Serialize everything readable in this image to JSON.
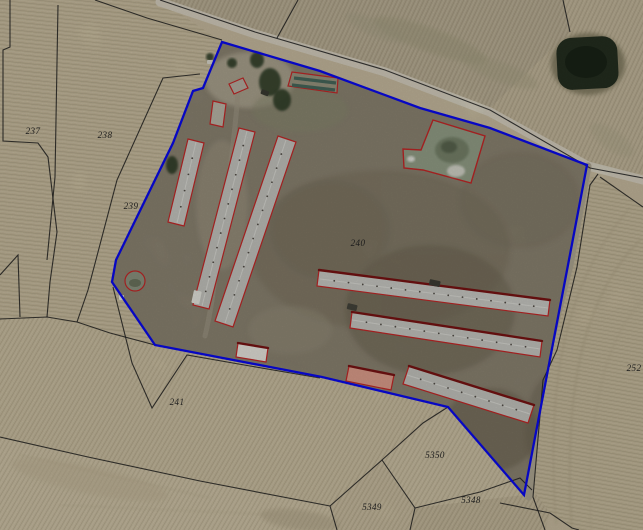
{
  "map": {
    "width": 643,
    "height": 530,
    "palette": {
      "base": "#c8bca0",
      "farm_ground": "#8d8573",
      "road": "#d7d1c0",
      "track": "#b0a894",
      "boundary_blue": "#0a0af0",
      "building_red": "#c62828",
      "building_dark_red": "#7a1414",
      "cadastral_line": "#1f1f1f",
      "label": "#1b1b1b",
      "pond_dark": "#252f21",
      "tree_green": "#2f3c28",
      "roof_gray": "#c9c9c3",
      "roof_pink": "#e0a18e",
      "roof_white": "#ebe9e1",
      "green_shed_stripe": "#47695c",
      "lagoon_green": "#95a189"
    },
    "parcel_labels": [
      {
        "text": "237",
        "x": 33,
        "y": 134
      },
      {
        "text": "238",
        "x": 105,
        "y": 138
      },
      {
        "text": "239",
        "x": 131,
        "y": 209
      },
      {
        "text": "240",
        "x": 358,
        "y": 246
      },
      {
        "text": "241",
        "x": 177,
        "y": 405
      },
      {
        "text": "5350",
        "x": 435,
        "y": 458
      },
      {
        "text": "5349",
        "x": 372,
        "y": 510
      },
      {
        "text": "5348",
        "x": 471,
        "y": 503
      },
      {
        "text": "252",
        "x": 634,
        "y": 371
      }
    ],
    "blue_boundary": {
      "points": "222,42 320,71 420,108 490,128 587,165 568,265 524,495 448,407 322,377 155,345 112,282 116,260 173,143 193,91 203,88",
      "width": 2.3
    },
    "cadastral_lines": [
      "10,0 10,47 3,50 3,141 38,143 48,157 57,232 50,282 47,317",
      "58,5 55,177 47,260",
      "0,275 18,255 20,317",
      "0,319 47,317 77,322 110,333 155,345",
      "200,74 163,78 117,180 88,290 77,322",
      "95,0 147,18 222,40",
      "160,0 255,32 385,70 490,110 590,168 643,178",
      "298,0 277,38",
      "563,0 570,32",
      "598,174 590,185 577,267 557,350 543,380 533,497 545,530",
      "600,177 643,207",
      "113,287 132,363 152,408 187,355 250,366 320,378",
      "0,437 88,457 200,481 330,506",
      "330,506 382,460 423,423 448,407",
      "330,506 337,530",
      "382,460 415,508 410,530",
      "415,508 480,492 520,478 532,490",
      "500,503 550,513 572,528 579,530"
    ],
    "fields": [
      {
        "name": "field-237-238",
        "points": "0,0 160,0 222,42 203,88 193,91 173,143 116,260 112,282 155,345 110,333 47,317 0,319",
        "fill": "#c6ba9c",
        "stripe": "p96"
      },
      {
        "name": "field-top-center",
        "points": "160,0 563,0 570,32 490,108 385,70 255,32",
        "fill": "#b7ac92",
        "stripe": "p25"
      },
      {
        "name": "field-pond-parcel",
        "points": "563,0 643,0 643,174 590,168 490,108 570,32",
        "fill": "#c0b498",
        "stripe": "p25"
      },
      {
        "name": "field-252",
        "points": "598,174 643,207 643,530 579,530 550,513 533,497 543,380 573,265 590,178",
        "fill": "#c4b89a",
        "stripe": "p100"
      },
      {
        "name": "field-bottom-right",
        "points": "415,508 533,490 550,513 545,530 410,530",
        "fill": "#c0b497",
        "stripe": "p30"
      },
      {
        "name": "field-5350",
        "points": "382,460 448,407 524,495 415,508",
        "fill": "#cbbfa2",
        "stripe": "p30"
      },
      {
        "name": "field-5349",
        "points": "330,506 382,460 415,508 410,530 337,530",
        "fill": "#c6ba9d",
        "stripe": "p30"
      },
      {
        "name": "field-241",
        "points": "0,319 47,317 110,333 155,345 322,377 448,407 423,423 382,460 330,506 200,481 88,457 0,437",
        "fill": "#c9bd9f",
        "stripe": "p30"
      },
      {
        "name": "field-bottom-left",
        "points": "0,437 88,457 200,481 330,506 337,530 0,530",
        "fill": "#cdc1a4",
        "stripe": "p30"
      }
    ],
    "field_accent_ellipses": [
      [
        430,
        40,
        60,
        12,
        "#a29c7e",
        0.45,
        20
      ],
      [
        500,
        72,
        40,
        10,
        "#a8a284",
        0.4,
        20
      ],
      [
        375,
        28,
        32,
        8,
        "#a8a287",
        0.4,
        24
      ],
      [
        612,
        140,
        26,
        10,
        "#b0a98c",
        0.4,
        35
      ],
      [
        90,
        480,
        80,
        14,
        "#c2b698",
        0.5,
        12
      ],
      [
        300,
        520,
        40,
        10,
        "#a89c80",
        0.4,
        8
      ]
    ],
    "field_accent_paths": [
      [
        "M640,240 C580,300 563,400 572,530",
        "#b6aa8c",
        2.5,
        0.55
      ],
      [
        "M643,300 C601,341 586,430 591,530",
        "#bbaf91",
        2.0,
        0.45
      ],
      [
        "M629,209 C558,290 547,400 556,523",
        "#b2a688",
        2.0,
        0.4
      ],
      [
        "M20,455 L210,498",
        "#b9ad90",
        1.5,
        0.35
      ],
      [
        "M60,505 L280,515",
        "#b9ad90",
        1.5,
        0.3
      ]
    ],
    "roads": [
      {
        "name": "main-road",
        "d": "M160,2 L255,34 L385,72 L490,112 L588,166 L643,180",
        "w": 9,
        "color": "#d7d1c0",
        "op": 1
      },
      {
        "name": "farm-track-east",
        "d": "M588,166 L570,265 L541,380 L529,497",
        "w": 7,
        "color": "#b0a894",
        "op": 1
      },
      {
        "name": "entrance-drive",
        "d": "M232,46 L242,78 L246,104",
        "w": 5,
        "color": "#c6bfab",
        "op": 0.9
      },
      {
        "name": "farm-inner-track",
        "d": "M239,80 C235,140 226,200 212,300 C209,318 207,328 205,336",
        "w": 5,
        "color": "#a59d88",
        "op": 0.65
      }
    ],
    "farm": {
      "fill": "#8d8573",
      "blotches": [
        [
          380,
          250,
          130,
          80,
          "#7b735e",
          0.45
        ],
        [
          430,
          310,
          85,
          65,
          "#6f6754",
          0.5
        ],
        [
          330,
          230,
          60,
          50,
          "#7a7260",
          0.45
        ],
        [
          490,
          430,
          48,
          42,
          "#6a6250",
          0.5
        ],
        [
          250,
          80,
          45,
          28,
          "#b4ac97",
          0.8
        ],
        [
          222,
          205,
          26,
          65,
          "#a29a86",
          0.55
        ],
        [
          290,
          330,
          42,
          24,
          "#98907c",
          0.55
        ],
        [
          300,
          110,
          48,
          22,
          "#8c8c72",
          0.5
        ],
        [
          520,
          200,
          60,
          48,
          "#7d7562",
          0.4
        ],
        [
          560,
          430,
          35,
          60,
          "#6c6452",
          0.4
        ],
        [
          250,
          380,
          60,
          20,
          "#8f8775",
          0.5
        ]
      ]
    },
    "pond": {
      "cx": 588,
      "cy": 64,
      "halo_rx": 37,
      "halo_ry": 31,
      "halo_fill": "#837d62",
      "x": 557,
      "y": 37,
      "w": 61,
      "h": 52,
      "rx": 15,
      "fill": "#252f21",
      "inner_fill": "#1a2417"
    },
    "lagoon": {
      "points": "433,120 485,136 471,183 423,170 404,168 403,149 421,150",
      "fill": "#95a189",
      "details": [
        [
          452,
          150,
          17,
          13,
          "#77836b"
        ],
        [
          449,
          147,
          8,
          6,
          "#5a654f"
        ],
        [
          456,
          171,
          9,
          6,
          "#d9d9cf"
        ],
        [
          411,
          159,
          4,
          3,
          "#e6e6df"
        ]
      ]
    },
    "tank": {
      "cx": 135,
      "cy": 281,
      "r": 10,
      "fill": "#8e9582",
      "inner": "#6d755f"
    },
    "trees": [
      [
        270,
        82,
        11,
        14
      ],
      [
        282,
        100,
        9,
        11
      ],
      [
        257,
        60,
        7,
        8
      ],
      [
        232,
        63,
        5,
        5
      ],
      [
        172,
        165,
        6,
        9
      ],
      [
        210,
        57,
        4,
        4
      ]
    ],
    "buildings": [
      {
        "name": "barn-left-1",
        "points": "188,139 204,143 184,226 168,222",
        "fill": "#c9c9c3",
        "ridge": "196,142 177,223",
        "vents": true
      },
      {
        "name": "barn-left-2",
        "points": "239,128 255,132 209,309 193,305",
        "fill": "#c6c6c0",
        "ridge": "247,131 202,306",
        "vents": true
      },
      {
        "name": "barn-left-3",
        "points": "278,136 296,142 233,327 215,321",
        "fill": "#c6c6c0",
        "ridge": "286,140 225,323",
        "vents": true
      },
      {
        "name": "barn-right-1",
        "points": "319,270 550,300 548,316 317,286",
        "fill": "#ccccc6",
        "ridge": "320,279 548,308",
        "top_edge": "319,270 550,300",
        "vents": true
      },
      {
        "name": "barn-right-2",
        "points": "352,312 542,341 540,357 350,328",
        "fill": "#c9c9c3",
        "ridge": "352,320 540,349",
        "top_edge": "352,312 542,341",
        "vents": true
      },
      {
        "name": "barn-right-3",
        "points": "409,366 534,405 528,423 403,384",
        "fill": "#c6c6c0",
        "ridge": "407,375 530,414",
        "top_edge": "409,366 534,405",
        "vents": true
      },
      {
        "name": "shed-top",
        "points": "229,84 243,78 248,88 234,94",
        "fill": "#b7b2a4"
      },
      {
        "name": "shed-left",
        "points": "213,101 226,104 223,127 210,124",
        "fill": "#bdb8aa"
      },
      {
        "name": "building-white",
        "points": "238,343 268,348 266,362 236,357",
        "fill": "#ebe9e1",
        "top_edge": "238,343 268,348"
      },
      {
        "name": "building-pink",
        "points": "349,366 394,375 391,390 346,381",
        "fill": "#e0a18e",
        "top_edge": "349,366 394,375"
      },
      {
        "name": "green-shed",
        "points": "292,72 338,78 337,93 288,86",
        "fill": "#9b9681",
        "stripes": [
          "294,78 336,83",
          "292,85 335,90"
        ]
      }
    ],
    "vehicles": [
      [
        194,
        290,
        8,
        13,
        12,
        "#e9e9e1"
      ],
      [
        119,
        295,
        5,
        5,
        0,
        "#ececdf"
      ],
      [
        348,
        303,
        10,
        6,
        14,
        "#45453c"
      ],
      [
        430,
        279,
        11,
        6,
        12,
        "#3f3e36"
      ],
      [
        262,
        89,
        8,
        5,
        20,
        "#3b3b33"
      ],
      [
        207,
        60,
        6,
        4,
        0,
        "#dddbcf"
      ]
    ]
  }
}
